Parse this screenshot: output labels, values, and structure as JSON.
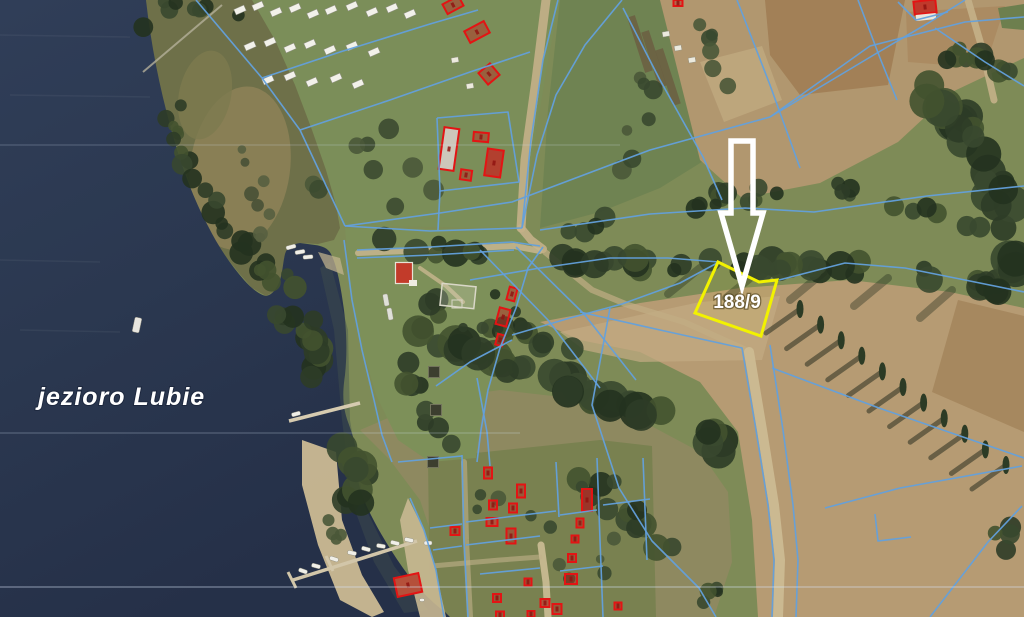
{
  "map": {
    "type": "aerial-cadastral-map",
    "water_label": "jezioro Lubie",
    "highlight_parcel": {
      "number": "188/9",
      "outline_color": "#f2f200"
    },
    "overlay": {
      "cadastral_line_color": "#63a0dc",
      "building_outline_color": "#e31414",
      "arrow_color": "#ffffff",
      "label_color": "#ffffff"
    },
    "water_color": "#2b3950"
  }
}
